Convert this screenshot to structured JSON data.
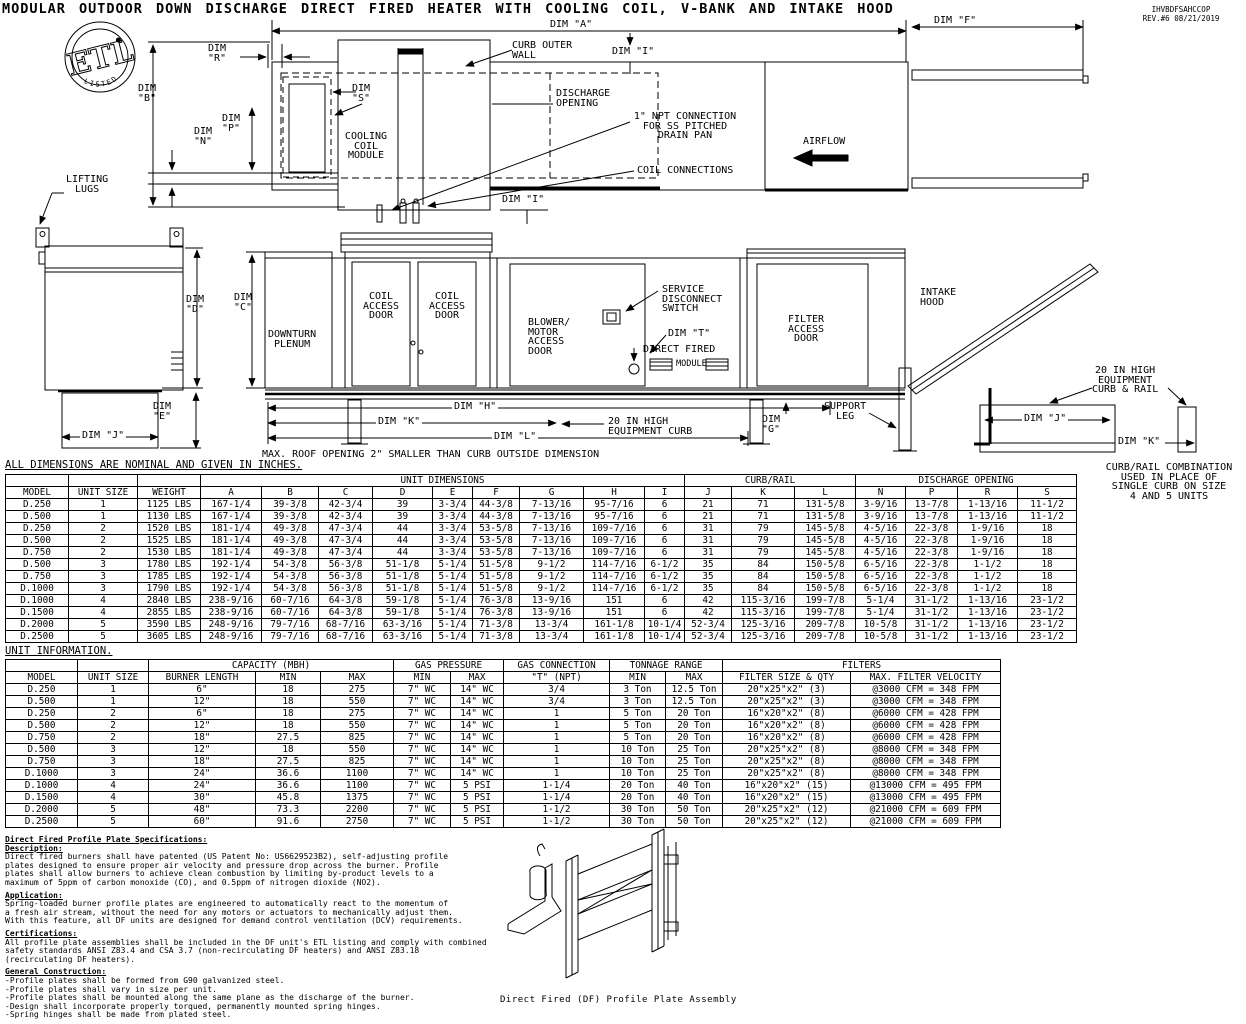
{
  "doc": {
    "title": "MODULAR OUTDOOR DOWN DISCHARGE DIRECT FIRED HEATER WITH COOLING COIL, V-BANK AND INTAKE HOOD",
    "number": "IHVBDFSAHCCOP",
    "rev_line": "REV.#6   08/21/2019"
  },
  "logo": {
    "etl": "ETL",
    "listed": "LISTED"
  },
  "colors": {
    "ink": "#000000",
    "paper": "#ffffff"
  },
  "dims": {
    "a": "DIM \"A\"",
    "b": "DIM\n\"B\"",
    "c": "DIM\n\"C\"",
    "d": "DIM\n\"D\"",
    "e": "DIM\n\"E\"",
    "f": "DIM \"F\"",
    "g": "DIM\n\"G\"",
    "h": "DIM \"H\"",
    "i": "DIM \"I\"",
    "j": "DIM \"J\"",
    "k": "DIM \"K\"",
    "l": "DIM \"L\"",
    "n": "DIM\n\"N\"",
    "p": "DIM\n\"P\"",
    "r": "DIM\n\"R\"",
    "s": "DIM\n\"S\"",
    "t": "DIM \"T\""
  },
  "plan": {
    "curb_outer_wall": "CURB OUTER\nWALL",
    "discharge_opening": "DISCHARGE\nOPENING",
    "npt_connection": "1\" NPT CONNECTION\nFOR SS PITCHED\nDRAIN PAN",
    "coil_connections": "COIL CONNECTIONS",
    "airflow": "AIRFLOW",
    "cooling_coil_module": "COOLING\nCOIL\nMODULE",
    "lifting_lugs": "LIFTING\nLUGS"
  },
  "side": {
    "downturn_plenum": "DOWNTURN\nPLENUM",
    "coil_access_door": "COIL\nACCESS\nDOOR",
    "blower_door": "BLOWER/\nMOTOR\nACCESS\nDOOR",
    "service_disconnect": "SERVICE\nDISCONNECT\nSWITCH",
    "direct_fired": "DIRECT FIRED",
    "module_word": "MODULE",
    "filter_access_door": "FILTER\nACCESS\nDOOR",
    "intake_hood": "INTAKE\nHOOD",
    "support_leg": "SUPPORT\nLEG",
    "equipment_curb_20": "20 IN HIGH\nEQUIPMENT CURB",
    "curb_rail_20": "20 IN HIGH\nEQUIPMENT\nCURB & RAIL"
  },
  "notes": {
    "roof": "MAX. ROOF OPENING 2\" SMALLER THAN CURB OUTSIDE DIMENSION",
    "nominal": "ALL DIMENSIONS ARE NOMINAL AND GIVEN IN INCHES.",
    "curb_rail_combo": "CURB/RAIL COMBINATION\nUSED IN PLACE OF\nSINGLE CURB ON SIZE\n4 AND 5 UNITS"
  },
  "dim_table": {
    "groups": {
      "unit_dimensions": "UNIT DIMENSIONS",
      "curb_rail": "CURB/RAIL",
      "discharge_opening": "DISCHARGE OPENING"
    },
    "columns": [
      "MODEL",
      "UNIT SIZE",
      "WEIGHT",
      "A",
      "B",
      "C",
      "D",
      "E",
      "F",
      "G",
      "H",
      "I",
      "J",
      "K",
      "L",
      "N",
      "P",
      "R",
      "S"
    ],
    "rows": [
      [
        "D.250",
        "1",
        "1125 LBS",
        "167-1/4",
        "39-3/8",
        "42-3/4",
        "39",
        "3-3/4",
        "44-3/8",
        "7-13/16",
        "95-7/16",
        "6",
        "21",
        "71",
        "131-5/8",
        "3-9/16",
        "13-7/8",
        "1-13/16",
        "11-1/2"
      ],
      [
        "D.500",
        "1",
        "1130 LBS",
        "167-1/4",
        "39-3/8",
        "42-3/4",
        "39",
        "3-3/4",
        "44-3/8",
        "7-13/16",
        "95-7/16",
        "6",
        "21",
        "71",
        "131-5/8",
        "3-9/16",
        "13-7/8",
        "1-13/16",
        "11-1/2"
      ],
      [
        "D.250",
        "2",
        "1520 LBS",
        "181-1/4",
        "49-3/8",
        "47-3/4",
        "44",
        "3-3/4",
        "53-5/8",
        "7-13/16",
        "109-7/16",
        "6",
        "31",
        "79",
        "145-5/8",
        "4-5/16",
        "22-3/8",
        "1-9/16",
        "18"
      ],
      [
        "D.500",
        "2",
        "1525 LBS",
        "181-1/4",
        "49-3/8",
        "47-3/4",
        "44",
        "3-3/4",
        "53-5/8",
        "7-13/16",
        "109-7/16",
        "6",
        "31",
        "79",
        "145-5/8",
        "4-5/16",
        "22-3/8",
        "1-9/16",
        "18"
      ],
      [
        "D.750",
        "2",
        "1530 LBS",
        "181-1/4",
        "49-3/8",
        "47-3/4",
        "44",
        "3-3/4",
        "53-5/8",
        "7-13/16",
        "109-7/16",
        "6",
        "31",
        "79",
        "145-5/8",
        "4-5/16",
        "22-3/8",
        "1-9/16",
        "18"
      ],
      [
        "D.500",
        "3",
        "1780 LBS",
        "192-1/4",
        "54-3/8",
        "56-3/8",
        "51-1/8",
        "5-1/4",
        "51-5/8",
        "9-1/2",
        "114-7/16",
        "6-1/2",
        "35",
        "84",
        "150-5/8",
        "6-5/16",
        "22-3/8",
        "1-1/2",
        "18"
      ],
      [
        "D.750",
        "3",
        "1785 LBS",
        "192-1/4",
        "54-3/8",
        "56-3/8",
        "51-1/8",
        "5-1/4",
        "51-5/8",
        "9-1/2",
        "114-7/16",
        "6-1/2",
        "35",
        "84",
        "150-5/8",
        "6-5/16",
        "22-3/8",
        "1-1/2",
        "18"
      ],
      [
        "D.1000",
        "3",
        "1790 LBS",
        "192-1/4",
        "54-3/8",
        "56-3/8",
        "51-1/8",
        "5-1/4",
        "51-5/8",
        "9-1/2",
        "114-7/16",
        "6-1/2",
        "35",
        "84",
        "150-5/8",
        "6-5/16",
        "22-3/8",
        "1-1/2",
        "18"
      ],
      [
        "D.1000",
        "4",
        "2840 LBS",
        "238-9/16",
        "60-7/16",
        "64-3/8",
        "59-1/8",
        "5-1/4",
        "76-3/8",
        "13-9/16",
        "151",
        "6",
        "42",
        "115-3/16",
        "199-7/8",
        "5-1/4",
        "31-1/2",
        "1-13/16",
        "23-1/2"
      ],
      [
        "D.1500",
        "4",
        "2855 LBS",
        "238-9/16",
        "60-7/16",
        "64-3/8",
        "59-1/8",
        "5-1/4",
        "76-3/8",
        "13-9/16",
        "151",
        "6",
        "42",
        "115-3/16",
        "199-7/8",
        "5-1/4",
        "31-1/2",
        "1-13/16",
        "23-1/2"
      ],
      [
        "D.2000",
        "5",
        "3590 LBS",
        "248-9/16",
        "79-7/16",
        "68-7/16",
        "63-3/16",
        "5-1/4",
        "71-3/8",
        "13-3/4",
        "161-1/8",
        "10-1/4",
        "52-3/4",
        "125-3/16",
        "209-7/8",
        "10-5/8",
        "31-1/2",
        "1-13/16",
        "23-1/2"
      ],
      [
        "D.2500",
        "5",
        "3605 LBS",
        "248-9/16",
        "79-7/16",
        "68-7/16",
        "63-3/16",
        "5-1/4",
        "71-3/8",
        "13-3/4",
        "161-1/8",
        "10-1/4",
        "52-3/4",
        "125-3/16",
        "209-7/8",
        "10-5/8",
        "31-1/2",
        "1-13/16",
        "23-1/2"
      ]
    ]
  },
  "unit_table": {
    "label": "UNIT INFORMATION.",
    "groups": {
      "capacity": "CAPACITY (MBH)",
      "gas_pressure": "GAS PRESSURE",
      "gas_connection": "GAS CONNECTION",
      "tonnage": "TONNAGE RANGE",
      "filters": "FILTERS"
    },
    "columns": [
      "MODEL",
      "UNIT SIZE",
      "BURNER LENGTH",
      "MIN",
      "MAX",
      "MIN",
      "MAX",
      "\"T\" (NPT)",
      "MIN",
      "MAX",
      "FILTER SIZE & QTY",
      "MAX. FILTER VELOCITY"
    ],
    "rows": [
      [
        "D.250",
        "1",
        "6\"",
        "18",
        "275",
        "7\" WC",
        "14\" WC",
        "3/4",
        "3 Ton",
        "12.5 Ton",
        "20\"x25\"x2\" (3)",
        "@3000 CFM = 348 FPM"
      ],
      [
        "D.500",
        "1",
        "12\"",
        "18",
        "550",
        "7\" WC",
        "14\" WC",
        "3/4",
        "3 Ton",
        "12.5 Ton",
        "20\"x25\"x2\" (3)",
        "@3000 CFM = 348 FPM"
      ],
      [
        "D.250",
        "2",
        "6\"",
        "18",
        "275",
        "7\" WC",
        "14\" WC",
        "1",
        "5 Ton",
        "20 Ton",
        "16\"x20\"x2\" (8)",
        "@6000 CFM = 428 FPM"
      ],
      [
        "D.500",
        "2",
        "12\"",
        "18",
        "550",
        "7\" WC",
        "14\" WC",
        "1",
        "5 Ton",
        "20 Ton",
        "16\"x20\"x2\" (8)",
        "@6000 CFM = 428 FPM"
      ],
      [
        "D.750",
        "2",
        "18\"",
        "27.5",
        "825",
        "7\" WC",
        "14\" WC",
        "1",
        "5 Ton",
        "20 Ton",
        "16\"x20\"x2\" (8)",
        "@6000 CFM = 428 FPM"
      ],
      [
        "D.500",
        "3",
        "12\"",
        "18",
        "550",
        "7\" WC",
        "14\" WC",
        "1",
        "10 Ton",
        "25 Ton",
        "20\"x25\"x2\" (8)",
        "@8000 CFM = 348 FPM"
      ],
      [
        "D.750",
        "3",
        "18\"",
        "27.5",
        "825",
        "7\" WC",
        "14\" WC",
        "1",
        "10 Ton",
        "25 Ton",
        "20\"x25\"x2\" (8)",
        "@8000 CFM = 348 FPM"
      ],
      [
        "D.1000",
        "3",
        "24\"",
        "36.6",
        "1100",
        "7\" WC",
        "14\" WC",
        "1",
        "10 Ton",
        "25 Ton",
        "20\"x25\"x2\" (8)",
        "@8000 CFM = 348 FPM"
      ],
      [
        "D.1000",
        "4",
        "24\"",
        "36.6",
        "1100",
        "7\" WC",
        "5 PSI",
        "1-1/4",
        "20 Ton",
        "40 Ton",
        "16\"x20\"x2\" (15)",
        "@13000 CFM = 495 FPM"
      ],
      [
        "D.1500",
        "4",
        "30\"",
        "45.8",
        "1375",
        "7\" WC",
        "5 PSI",
        "1-1/4",
        "20 Ton",
        "40 Ton",
        "16\"x20\"x2\" (15)",
        "@13000 CFM = 495 FPM"
      ],
      [
        "D.2000",
        "5",
        "48\"",
        "73.3",
        "2200",
        "7\" WC",
        "5 PSI",
        "1-1/2",
        "30 Ton",
        "50 Ton",
        "20\"x25\"x2\" (12)",
        "@21000 CFM = 609 FPM"
      ],
      [
        "D.2500",
        "5",
        "60\"",
        "91.6",
        "2750",
        "7\" WC",
        "5 PSI",
        "1-1/2",
        "30 Ton",
        "50 Ton",
        "20\"x25\"x2\" (12)",
        "@21000 CFM = 609 FPM"
      ]
    ]
  },
  "specs": {
    "heading": "Direct Fired Profile Plate Specifications:",
    "description_title": "Description:",
    "description_body": "Direct fired burners shall have patented (US Patent No: US6629523B2), self-adjusting profile\nplates designed to ensure proper air velocity and pressure drop across the burner. Profile\nplates shall allow burners to achieve clean combustion by limiting by-product levels to a\nmaximum of 5ppm of carbon monoxide (CO), and 0.5ppm of nitrogen dioxide (NO2).",
    "application_title": "Application:",
    "application_body": "Spring-loaded burner profile plates are engineered to automatically react to the momentum of\na fresh air stream, without the need for any motors or actuators to mechanically adjust them.\nWith this feature, all DF units are designed for demand control ventilation (DCV) requirements.",
    "certifications_title": "Certifications:",
    "certifications_body": "All profile plate assemblies shall be included in the DF unit's ETL listing and comply with combined\nsafety standards ANSI Z83.4 and CSA 3.7 (non-recirculating DF heaters) and ANSI Z83.18\n(recirculating DF heaters).",
    "construction_title": "General Construction:",
    "construction_body": "-Profile plates shall be formed from G90 galvanized steel.\n-Profile plates shall vary in size per unit.\n-Profile plates shall be mounted along the same plane as the discharge of the burner.\n-Design shall incorporate properly torqued, permanently mounted spring hinges.\n-Spring hinges shall be made from plated steel."
  },
  "figure_caption": "Direct Fired (DF) Profile Plate Assembly"
}
